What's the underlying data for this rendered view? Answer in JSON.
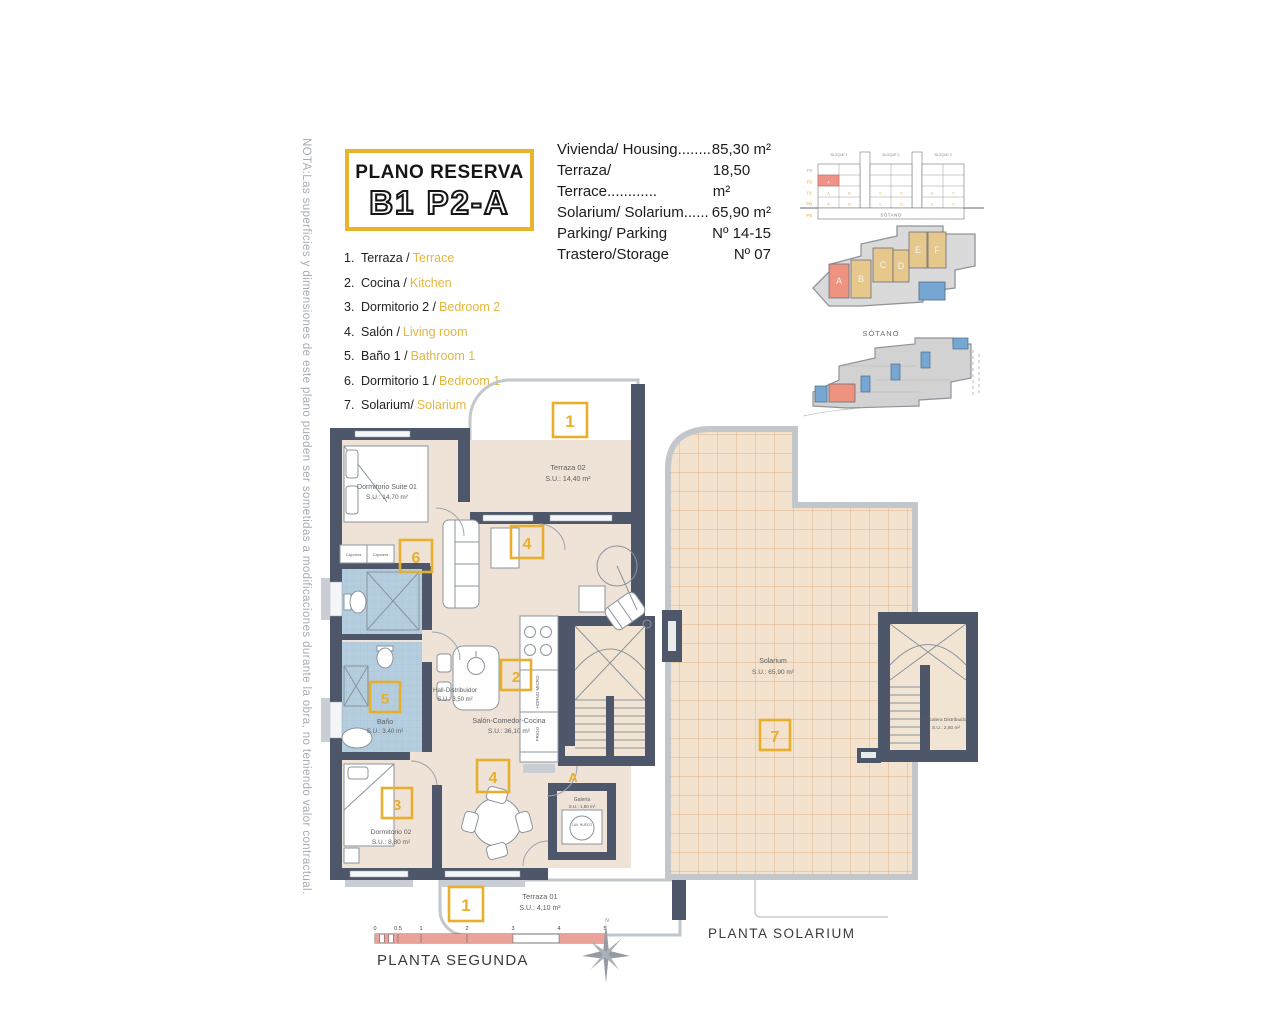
{
  "note": {
    "text": "NOTA:Las superficies y dimensiones de este plano pueden ser sometidas a modificaciones durante la obra, no teniendo valor contractual."
  },
  "title": {
    "line1": "PLANO RESERVA",
    "line2": "B1 P2-A"
  },
  "specs": {
    "rows": [
      {
        "label": "Vivienda/ Housing........",
        "value": "85,30 m²"
      },
      {
        "label": "Terraza/ Terrace............",
        "value": "18,50 m²"
      },
      {
        "label": "Solarium/ Solarium......",
        "value": "65,90 m²"
      },
      {
        "label": "Parking/ Parking",
        "value": "Nº 14-15"
      },
      {
        "label": "Trastero/Storage",
        "value": "Nº 07"
      }
    ]
  },
  "legend": {
    "items": [
      {
        "num": "1.",
        "es": "Terraza /",
        "en": "Terrace"
      },
      {
        "num": "2.",
        "es": "Cocina /",
        "en": "Kitchen"
      },
      {
        "num": "3.",
        "es": "Dormitorio 2 /",
        "en": "Bedroom 2"
      },
      {
        "num": "4.",
        "es": "Salón /",
        "en": "Living room"
      },
      {
        "num": "5.",
        "es": "Baño 1 /",
        "en": "Bathroom 1"
      },
      {
        "num": "6.",
        "es": "Dormitorio 1 /",
        "en": "Bedroom 1"
      },
      {
        "num": "7.",
        "es": "Solarium/",
        "en": "Solarium"
      }
    ]
  },
  "elevation": {
    "floors": [
      "P3",
      "P2",
      "P1",
      "PB",
      "PS"
    ],
    "blocks": [
      "BLOQUE 1",
      "BLOQUE 2",
      "BLOQUE 3"
    ],
    "units": [
      "A",
      "B",
      "C",
      "D",
      "E",
      "F"
    ],
    "basement": "SÓTANO"
  },
  "siteplan": {
    "letters": [
      "A",
      "B",
      "C",
      "D",
      "E",
      "F"
    ]
  },
  "sotano": {
    "label": "SÓTANO"
  },
  "plan2": {
    "terraza02": {
      "name": "Terraza 02",
      "area": "S.U.: 14,40 m²",
      "badge": "1"
    },
    "suite": {
      "name": "Dormitorio Suite 01",
      "area": "S.U.: 14,70 m²",
      "badge": "6"
    },
    "cajonera1": "Cajonera",
    "cajonera2": "Cajonera",
    "bano": {
      "name": "Baño",
      "area": "S.U.: 3,40 m²",
      "badge": "5"
    },
    "hall": {
      "name": "Hall-Distribuidor",
      "area": "S.U.: 3,50 m²"
    },
    "salon": {
      "name": "Salón-Comedor-Cocina",
      "area": "S.U.: 36,10 m²",
      "badge_cocina": "2",
      "badge_salon_top": "4",
      "badge_salon_bottom": "4"
    },
    "horno": "HORNO MICRO",
    "frigo": "FRIGO",
    "dorm02": {
      "name": "Dormitorio 02",
      "area": "S.U.: 8,80 m²",
      "badge": "3"
    },
    "galeria": {
      "name": "Galería",
      "area": "S.U.: 1,80 m²",
      "appliance": "LAV. HUECO"
    },
    "terraza01": {
      "name": "Terraza 01",
      "area": "S.U.: 4,10 m²",
      "badge": "1"
    },
    "door": "A",
    "north": "N",
    "label": "PLANTA SEGUNDA",
    "scale": [
      "0",
      "0.5",
      "1",
      "2",
      "3",
      "4",
      "5"
    ]
  },
  "solarium": {
    "name": "Solarium",
    "area": "S.U.: 65,90 m²",
    "badge": "7",
    "escalera": {
      "name": "Escalera Distribuidor",
      "area": "S.U.: 2,60 m²"
    },
    "label": "PLANTA SOLARIUM"
  },
  "colors": {
    "accent": "#E8AF2D",
    "wall": "#4D5769",
    "floor": "#EFE2D6",
    "tile_line": "#E0B183",
    "bath_blue": "#B5CEDF",
    "salmon": "#ED9380",
    "tan": "#E6C78C",
    "blue_block": "#76A7D2",
    "site_gray": "#D8D8D8",
    "scale_red": "#EBA29A"
  }
}
